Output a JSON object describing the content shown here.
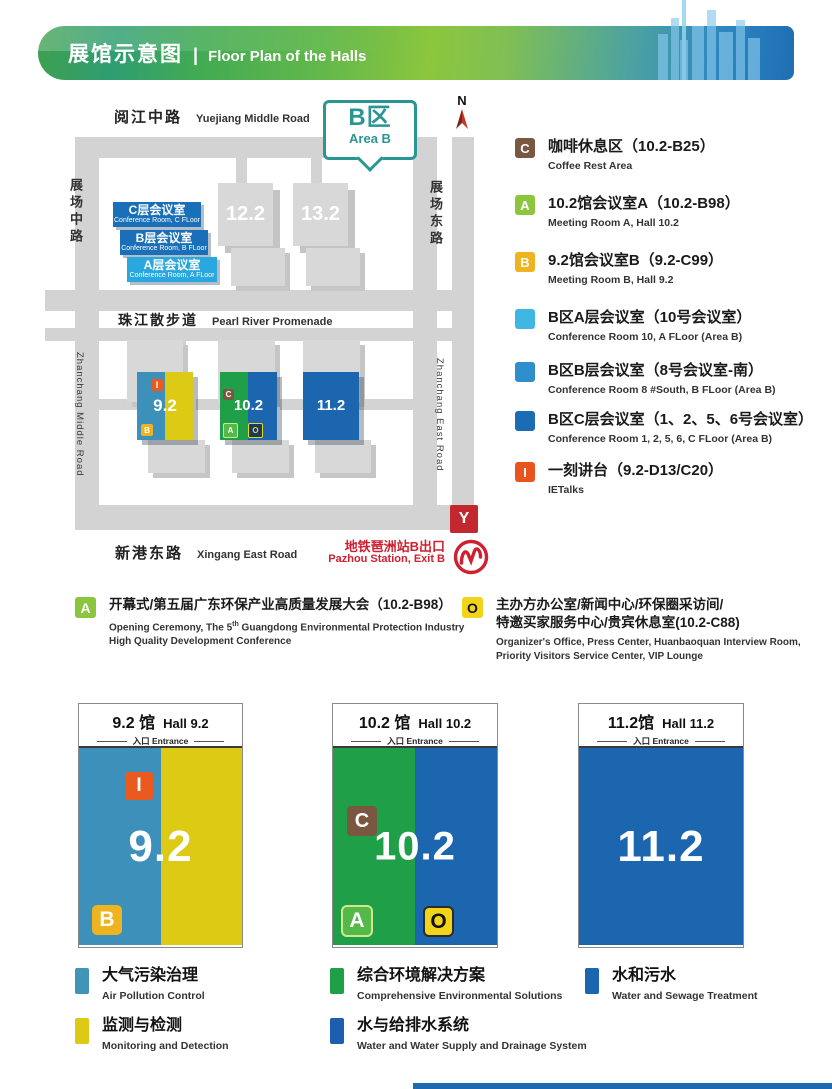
{
  "header": {
    "title_cn": "展馆示意图",
    "divider": "|",
    "title_en": "Floor Plan of the Halls"
  },
  "map": {
    "north_label": "N",
    "area_badge": {
      "cn": "B区",
      "en": "Area B"
    },
    "roads": {
      "top_cn": "阅江中路",
      "top_en": "Yuejiang Middle Road",
      "left_cn": "展场中路",
      "left_en": "Zhanchang Middle Road",
      "right_cn": "展场东路",
      "right_en": "Zhanchang East Road",
      "middle_cn": "珠江散步道",
      "middle_en": "Pearl River Promenade",
      "bottom_cn": "新港东路",
      "bottom_en": "Xingang East Road"
    },
    "halls_upper": [
      {
        "label": "12.2"
      },
      {
        "label": "13.2"
      }
    ],
    "ribbons": [
      {
        "cn": "C层会议室",
        "en": "Conference Room, C FLoor"
      },
      {
        "cn": "B层会议室",
        "en": "Conference Room, B FLoor"
      },
      {
        "cn": "A层会议室",
        "en": "Conference Room, A FLoor"
      }
    ],
    "halls_lower": [
      {
        "label": "9.2"
      },
      {
        "label": "10.2"
      },
      {
        "label": "11.2"
      }
    ],
    "hall_badges": {
      "i": "I",
      "b": "B",
      "c": "C",
      "a": "A",
      "o": "O"
    },
    "metro": {
      "exit_letter": "Y",
      "cn": "地铁琶洲站B出口",
      "en": "Pazhou Station, Exit B"
    }
  },
  "legend_right": {
    "items": [
      {
        "icon": "C",
        "title": "咖啡休息区（10.2-B25）",
        "sub": "Coffee Rest Area",
        "color": "#7a5741"
      },
      {
        "icon": "A",
        "title": "10.2馆会议室A（10.2-B98）",
        "sub": "Meeting Room A, Hall 10.2",
        "color": "#8cc63e"
      },
      {
        "icon": "B",
        "title": "9.2馆会议室B（9.2-C99）",
        "sub": "Meeting Room B, Hall 9.2",
        "color": "#efb320"
      },
      {
        "icon": "",
        "title": "B区A层会议室（10号会议室）",
        "sub": "Conference Room 10, A FLoor (Area B)",
        "color": "#3fb7e4"
      },
      {
        "icon": "",
        "title": "B区B层会议室（8号会议室-南）",
        "sub": "Conference Room 8 #South, B FLoor (Area B)",
        "color": "#2e8fcc"
      },
      {
        "icon": "",
        "title": "B区C层会议室（1、2、5、6号会议室）",
        "sub": "Conference Room 1, 2, 5, 6, C FLoor (Area B)",
        "color": "#1b6cb4"
      },
      {
        "icon": "I",
        "title": "一刻讲台（9.2-D13/C20）",
        "sub": "IETalks",
        "color": "#e8541e"
      }
    ]
  },
  "legend_mid": {
    "a": {
      "icon": "A",
      "title": "开幕式/第五届广东环保产业高质量发展大会（10.2-B98）",
      "sub1_pre": "Opening Ceremony, The 5",
      "sub1_sup": "th",
      "sub1_rest": " Guangdong Environmental Protection Industry",
      "sub2": "High Quality Development Conference"
    },
    "o": {
      "icon": "O",
      "title1": "主办方办公室/新闻中心/环保圈采访间/",
      "title2": "特邀买家服务中心/贵宾休息室(10.2-C88)",
      "sub1": "Organizer's Office, Press Center, Huanbaoquan Interview Room,",
      "sub2": "Priority Visitors Service Center, VIP Lounge"
    }
  },
  "hall_cards": [
    {
      "title_cn": "9.2 馆",
      "title_en": "Hall 9.2",
      "entrance": "入口 Entrance",
      "number": "9.2",
      "badge_top": "I",
      "badge_bl": "B"
    },
    {
      "title_cn": "10.2 馆",
      "title_en": "Hall 10.2",
      "entrance": "入口 Entrance",
      "number": "10.2",
      "badge_top": "C",
      "badge_bl": "A",
      "badge_br": "O"
    },
    {
      "title_cn": "11.2馆",
      "title_en": "Hall 11.2",
      "entrance": "入口 Entrance",
      "number": "11.2"
    }
  ],
  "legend_bottom": {
    "items": [
      {
        "cn": "大气污染治理",
        "en": "Air Pollution Control",
        "color": "#4193b8"
      },
      {
        "cn": "监测与检测",
        "en": "Monitoring and Detection",
        "color": "#ddca15"
      },
      {
        "cn": "综合环境解决方案",
        "en": "Comprehensive Environmental Solutions",
        "color": "#1fa048"
      },
      {
        "cn": "水与给排水系统",
        "en": "Water and Water Supply and Drainage System",
        "color": "#1d5fae"
      },
      {
        "cn": "水和污水",
        "en": "Water and Sewage Treatment",
        "color": "#1c66b0"
      }
    ]
  },
  "colors": {
    "hall_teal": "#3d90ba",
    "hall_yellow": "#ddca15",
    "hall_green": "#1fa048",
    "hall_blue": "#1c66b0",
    "badge_i": "#ea5a1f",
    "badge_b": "#eeb41f",
    "badge_c": "#7a5741",
    "badge_a": "#8cc63e",
    "badge_o": "#f2d41b",
    "metro_red": "#cf2030",
    "area_teal": "#2a9693",
    "road_gray": "#d3d3d3"
  }
}
